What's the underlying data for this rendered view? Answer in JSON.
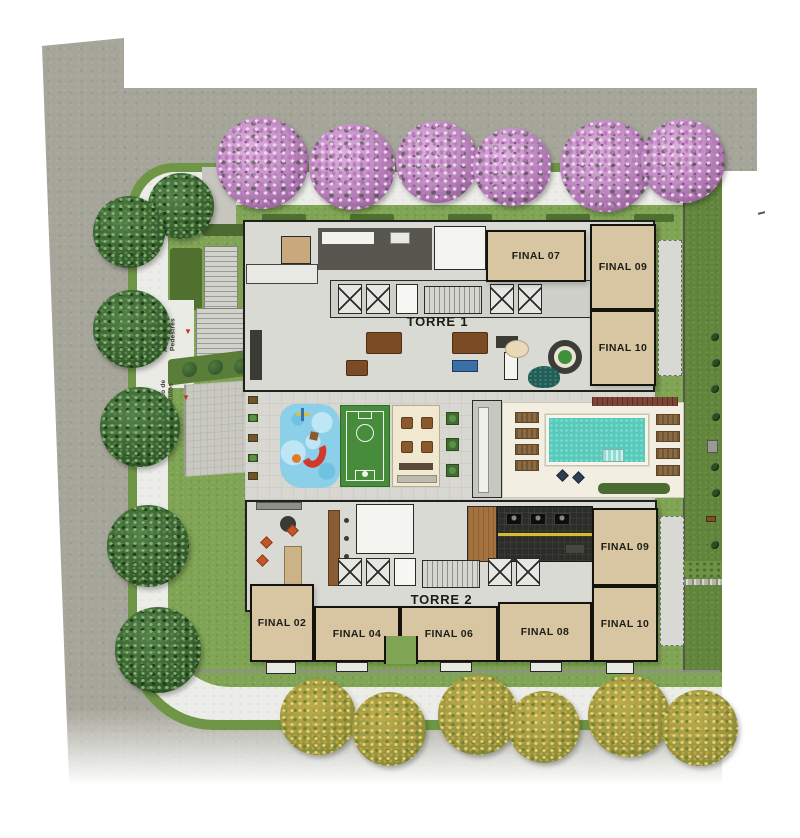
{
  "plan": {
    "towers": [
      {
        "name": "TORRE 1",
        "units": [
          {
            "label": "FINAL 07"
          },
          {
            "label": "FINAL 09"
          },
          {
            "label": "FINAL 10"
          }
        ]
      },
      {
        "name": "TORRE 2",
        "units": [
          {
            "label": "FINAL 02"
          },
          {
            "label": "FINAL 04"
          },
          {
            "label": "FINAL 06"
          },
          {
            "label": "FINAL 08"
          },
          {
            "label": "FINAL 09"
          },
          {
            "label": "FINAL 10"
          }
        ]
      }
    ],
    "access": {
      "pedestrians": "Acesso de Pedestres",
      "vehicles": "Acesso de Veículos",
      "marker": "▼"
    }
  },
  "colors": {
    "street": "#a5a59a",
    "sidewalk": "#ecece8",
    "lawn": "#7fa454",
    "lawn-dark": "#62853c",
    "unit": "#d8c6a2",
    "plate": "#dadad5",
    "wall": "#20201d",
    "deck": "#f2eee1",
    "pool": "#58cabc",
    "court": "#478c3a",
    "playground": "#8ccfe9",
    "gym": "#2c2c28",
    "gym-line": "#d8bc2e",
    "wood": "#a5713f",
    "accent-red": "#c4332b",
    "blossom": "#c795c8",
    "tree-green": "#3a6132",
    "tree-autumn": "#a09b40"
  }
}
